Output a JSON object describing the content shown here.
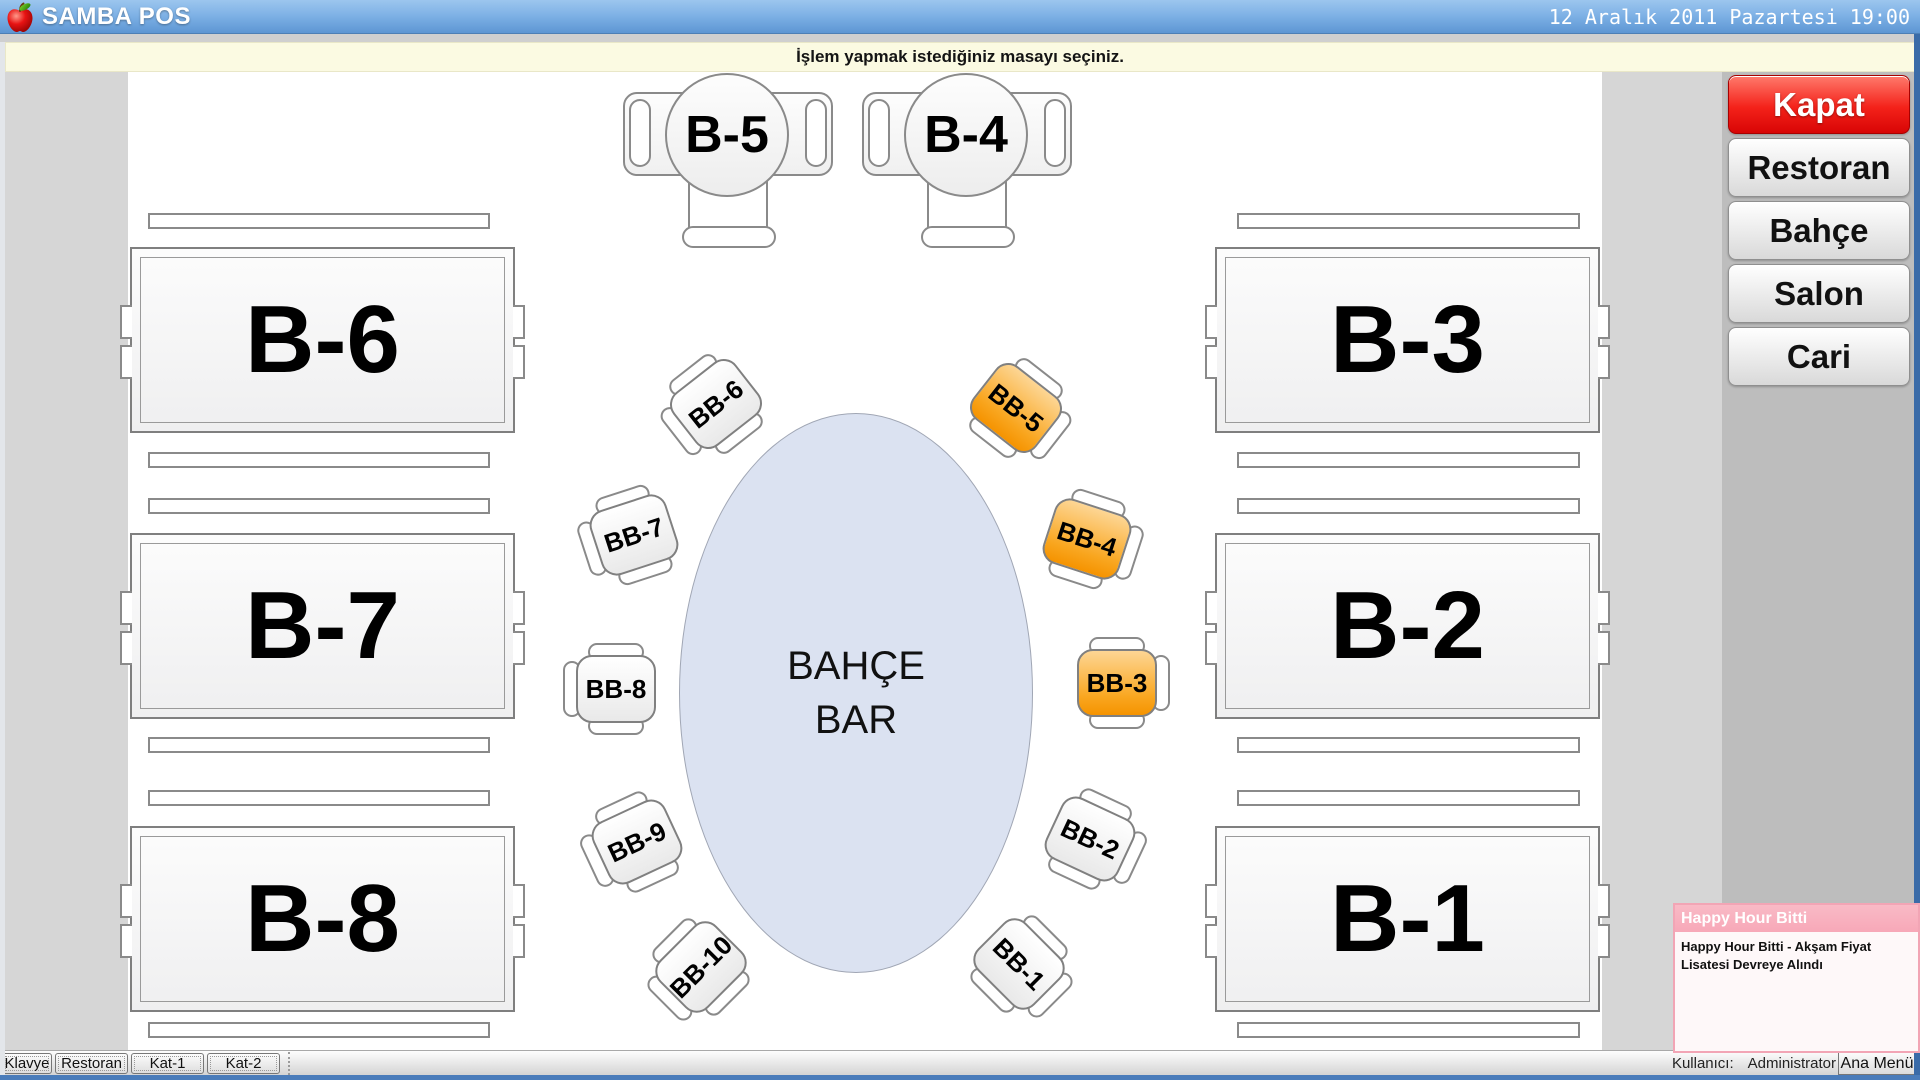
{
  "titlebar": {
    "app_title": "SAMBA POS",
    "datetime": "12 Aralık 2011 Pazartesi 19:00"
  },
  "message_bar": {
    "text": "İşlem yapmak istediğiniz masayı seçiniz."
  },
  "sidebar": {
    "buttons": [
      {
        "label": "Kapat",
        "accent": "#ED1C24"
      },
      {
        "label": "Restoran"
      },
      {
        "label": "Bahçe"
      },
      {
        "label": "Salon"
      },
      {
        "label": "Cari"
      }
    ]
  },
  "floor": {
    "round_tables": [
      {
        "id": "B-5"
      },
      {
        "id": "B-4"
      }
    ],
    "big_tables": [
      {
        "id": "B-6"
      },
      {
        "id": "B-7"
      },
      {
        "id": "B-8"
      },
      {
        "id": "B-3"
      },
      {
        "id": "B-2"
      },
      {
        "id": "B-1"
      }
    ],
    "bar": {
      "label_line1": "BAHÇE",
      "label_line2": "BAR"
    },
    "bar_chairs": [
      {
        "id": "BB-1",
        "occupied": false
      },
      {
        "id": "BB-2",
        "occupied": false
      },
      {
        "id": "BB-3",
        "occupied": true
      },
      {
        "id": "BB-4",
        "occupied": true
      },
      {
        "id": "BB-5",
        "occupied": true
      },
      {
        "id": "BB-6",
        "occupied": false
      },
      {
        "id": "BB-7",
        "occupied": false
      },
      {
        "id": "BB-8",
        "occupied": false
      },
      {
        "id": "BB-9",
        "occupied": false
      },
      {
        "id": "BB-10",
        "occupied": false
      }
    ],
    "occupied_color": "#F8A01E"
  },
  "bottom_bar": {
    "buttons": [
      {
        "label": "Klavye"
      },
      {
        "label": "Restoran"
      },
      {
        "label": "Kat-1"
      },
      {
        "label": "Kat-2"
      }
    ],
    "user_label": "Kullanıcı:",
    "user_name": "Administrator",
    "menu_button": "Ana Menü"
  },
  "notification": {
    "title": "Happy Hour Bitti",
    "body": "Happy Hour Bitti - Akşam Fiyat Lisatesi Devreye Alındı",
    "accent": "#F6A8BB"
  }
}
